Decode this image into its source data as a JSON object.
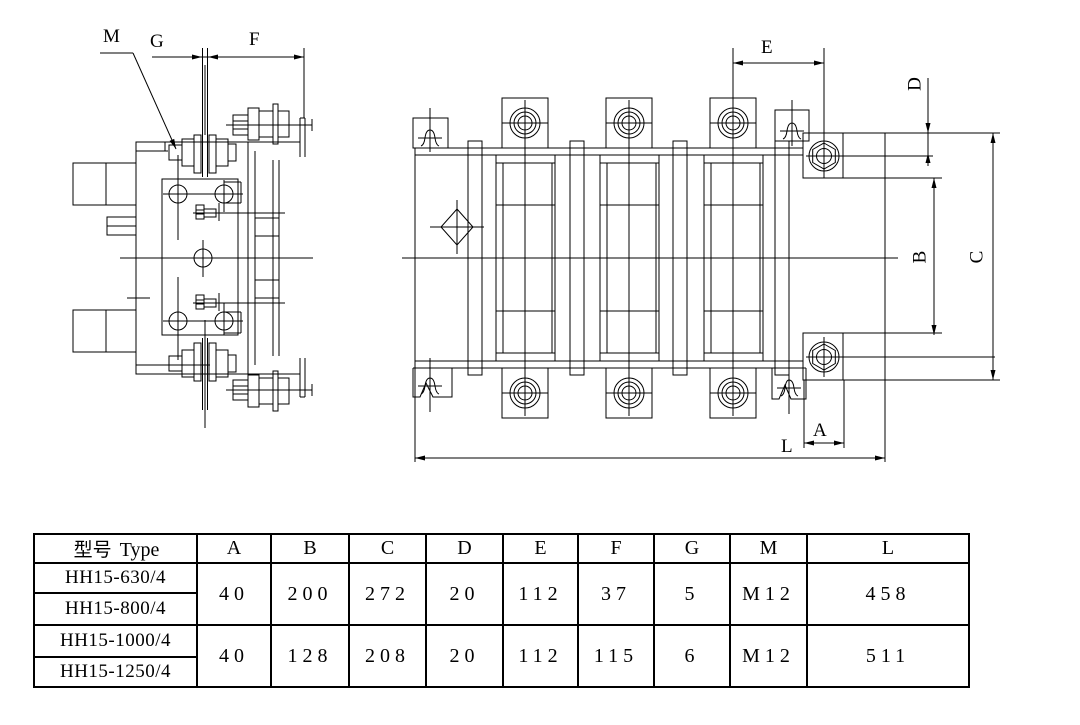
{
  "dim_labels": {
    "M": "M",
    "G": "G",
    "F": "F",
    "E": "E",
    "D": "D",
    "B": "B",
    "C": "C",
    "A": "A",
    "L": "L"
  },
  "table": {
    "header": {
      "type_zh": "型号",
      "type_en": "Type",
      "cols": [
        "A",
        "B",
        "C",
        "D",
        "E",
        "F",
        "G",
        "M",
        "L"
      ]
    },
    "groups": [
      {
        "models": [
          "HH15-630/4",
          "HH15-800/4"
        ],
        "values": [
          "40",
          "200",
          "272",
          "20",
          "112",
          "37",
          "5",
          "M12",
          "458"
        ]
      },
      {
        "models": [
          "HH15-1000/4",
          "HH15-1250/4"
        ],
        "values": [
          "40",
          "128",
          "208",
          "20",
          "112",
          "115",
          "6",
          "M12",
          "511"
        ]
      }
    ]
  }
}
